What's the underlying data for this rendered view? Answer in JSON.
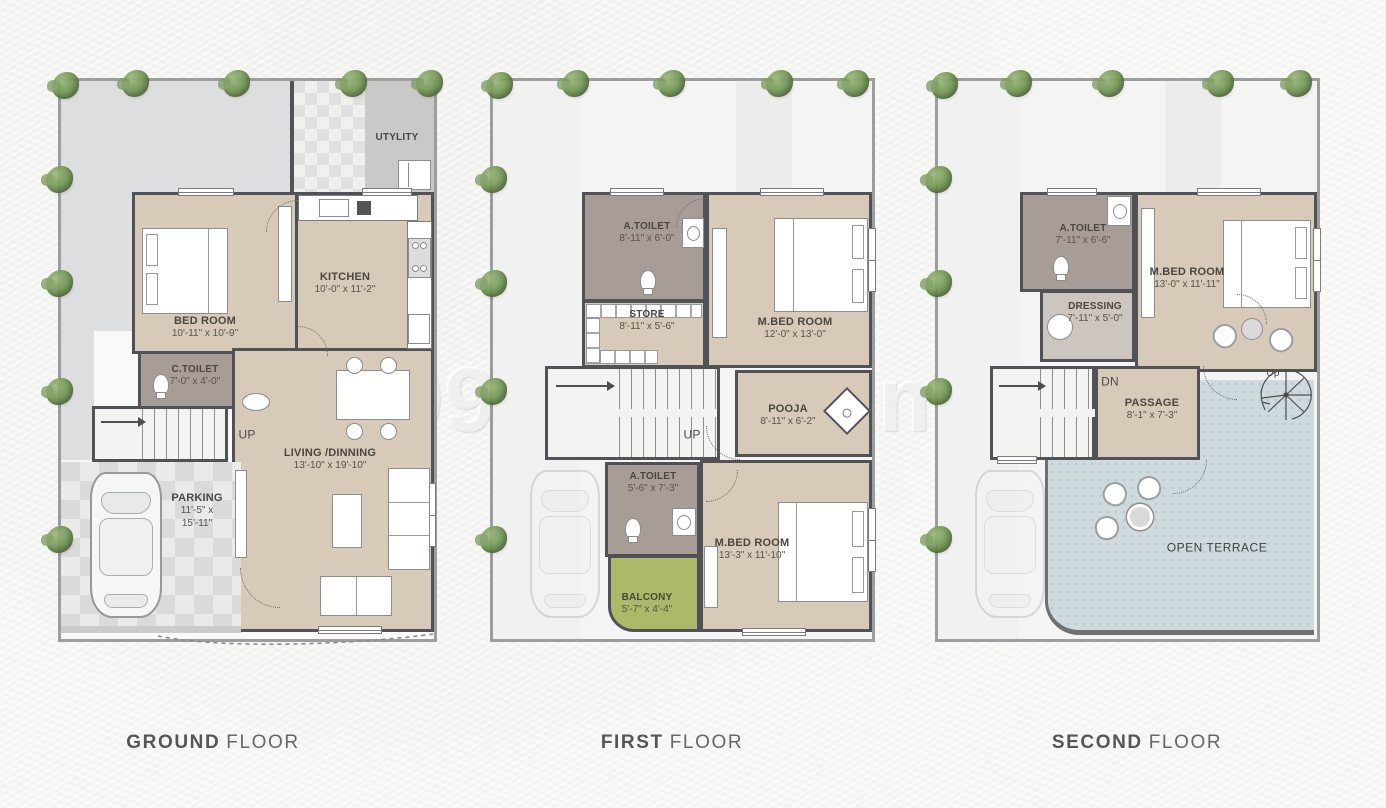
{
  "watermark": "99acres.com",
  "colors": {
    "wall": "#515257",
    "room_floor": "#d8cab8",
    "toilet_floor": "#a89d96",
    "balcony_green": "#abb968",
    "terrace_blue": "#cedade",
    "yard_grey": "#dcdedf",
    "tree_green": "#6d9150",
    "title_text": "#55565a"
  },
  "plans": [
    {
      "title": {
        "bold": "GROUND",
        "light": "FLOOR"
      },
      "rooms": {
        "utility": {
          "label": "UTYLITY"
        },
        "kitchen": {
          "label": "KITCHEN",
          "dims": "10'-0\" x 11'-2\""
        },
        "bedroom": {
          "label": "BED ROOM",
          "dims": "10'-11\" x 10'-9\""
        },
        "ctoilet": {
          "label": "C.TOILET",
          "dims": "7'-0\" x 4'-0\""
        },
        "stairs": {
          "label": "UP"
        },
        "living": {
          "label": "LIVING /DINNING",
          "dims": "13'-10\" x 19'-10\""
        },
        "parking": {
          "label": "PARKING",
          "dims_line1": "11'-5\" x",
          "dims_line2": "15'-11\""
        }
      }
    },
    {
      "title": {
        "bold": "FIRST",
        "light": "FLOOR"
      },
      "rooms": {
        "atoilet_top": {
          "label": "A.TOILET",
          "dims": "8'-11\" x 6'-0\""
        },
        "store": {
          "label": "STORE",
          "dims": "8'-11\" x 5'-6\""
        },
        "mbed_top": {
          "label": "M.BED ROOM",
          "dims": "12'-0\" x 13'-0\""
        },
        "stairs": {
          "label": "UP"
        },
        "pooja": {
          "label": "POOJA",
          "dims": "8'-11\" x 6'-2\""
        },
        "atoilet_bottom": {
          "label": "A.TOILET",
          "dims": "5'-6\" x 7'-3\""
        },
        "mbed_bottom": {
          "label": "M.BED ROOM",
          "dims": "13'-3\" x 11'-10\""
        },
        "balcony": {
          "label": "BALCONY",
          "dims": "5'-7\" x 4'-4\""
        }
      }
    },
    {
      "title": {
        "bold": "SECOND",
        "light": "FLOOR"
      },
      "rooms": {
        "atoilet": {
          "label": "A.TOILET",
          "dims": "7'-11\" x 6'-6\""
        },
        "dressing": {
          "label": "DRESSING",
          "dims": "7'-11\" x 5'-0\""
        },
        "mbed": {
          "label": "M.BED ROOM",
          "dims": "13'-0\" x 11'-11\""
        },
        "stairs": {
          "label": "DN"
        },
        "passage": {
          "label": "PASSAGE",
          "dims": "8'-1\" x 7'-3\""
        },
        "terrace": {
          "label": "OPEN TERRACE"
        },
        "spiral": {
          "label": "Up"
        }
      }
    }
  ]
}
